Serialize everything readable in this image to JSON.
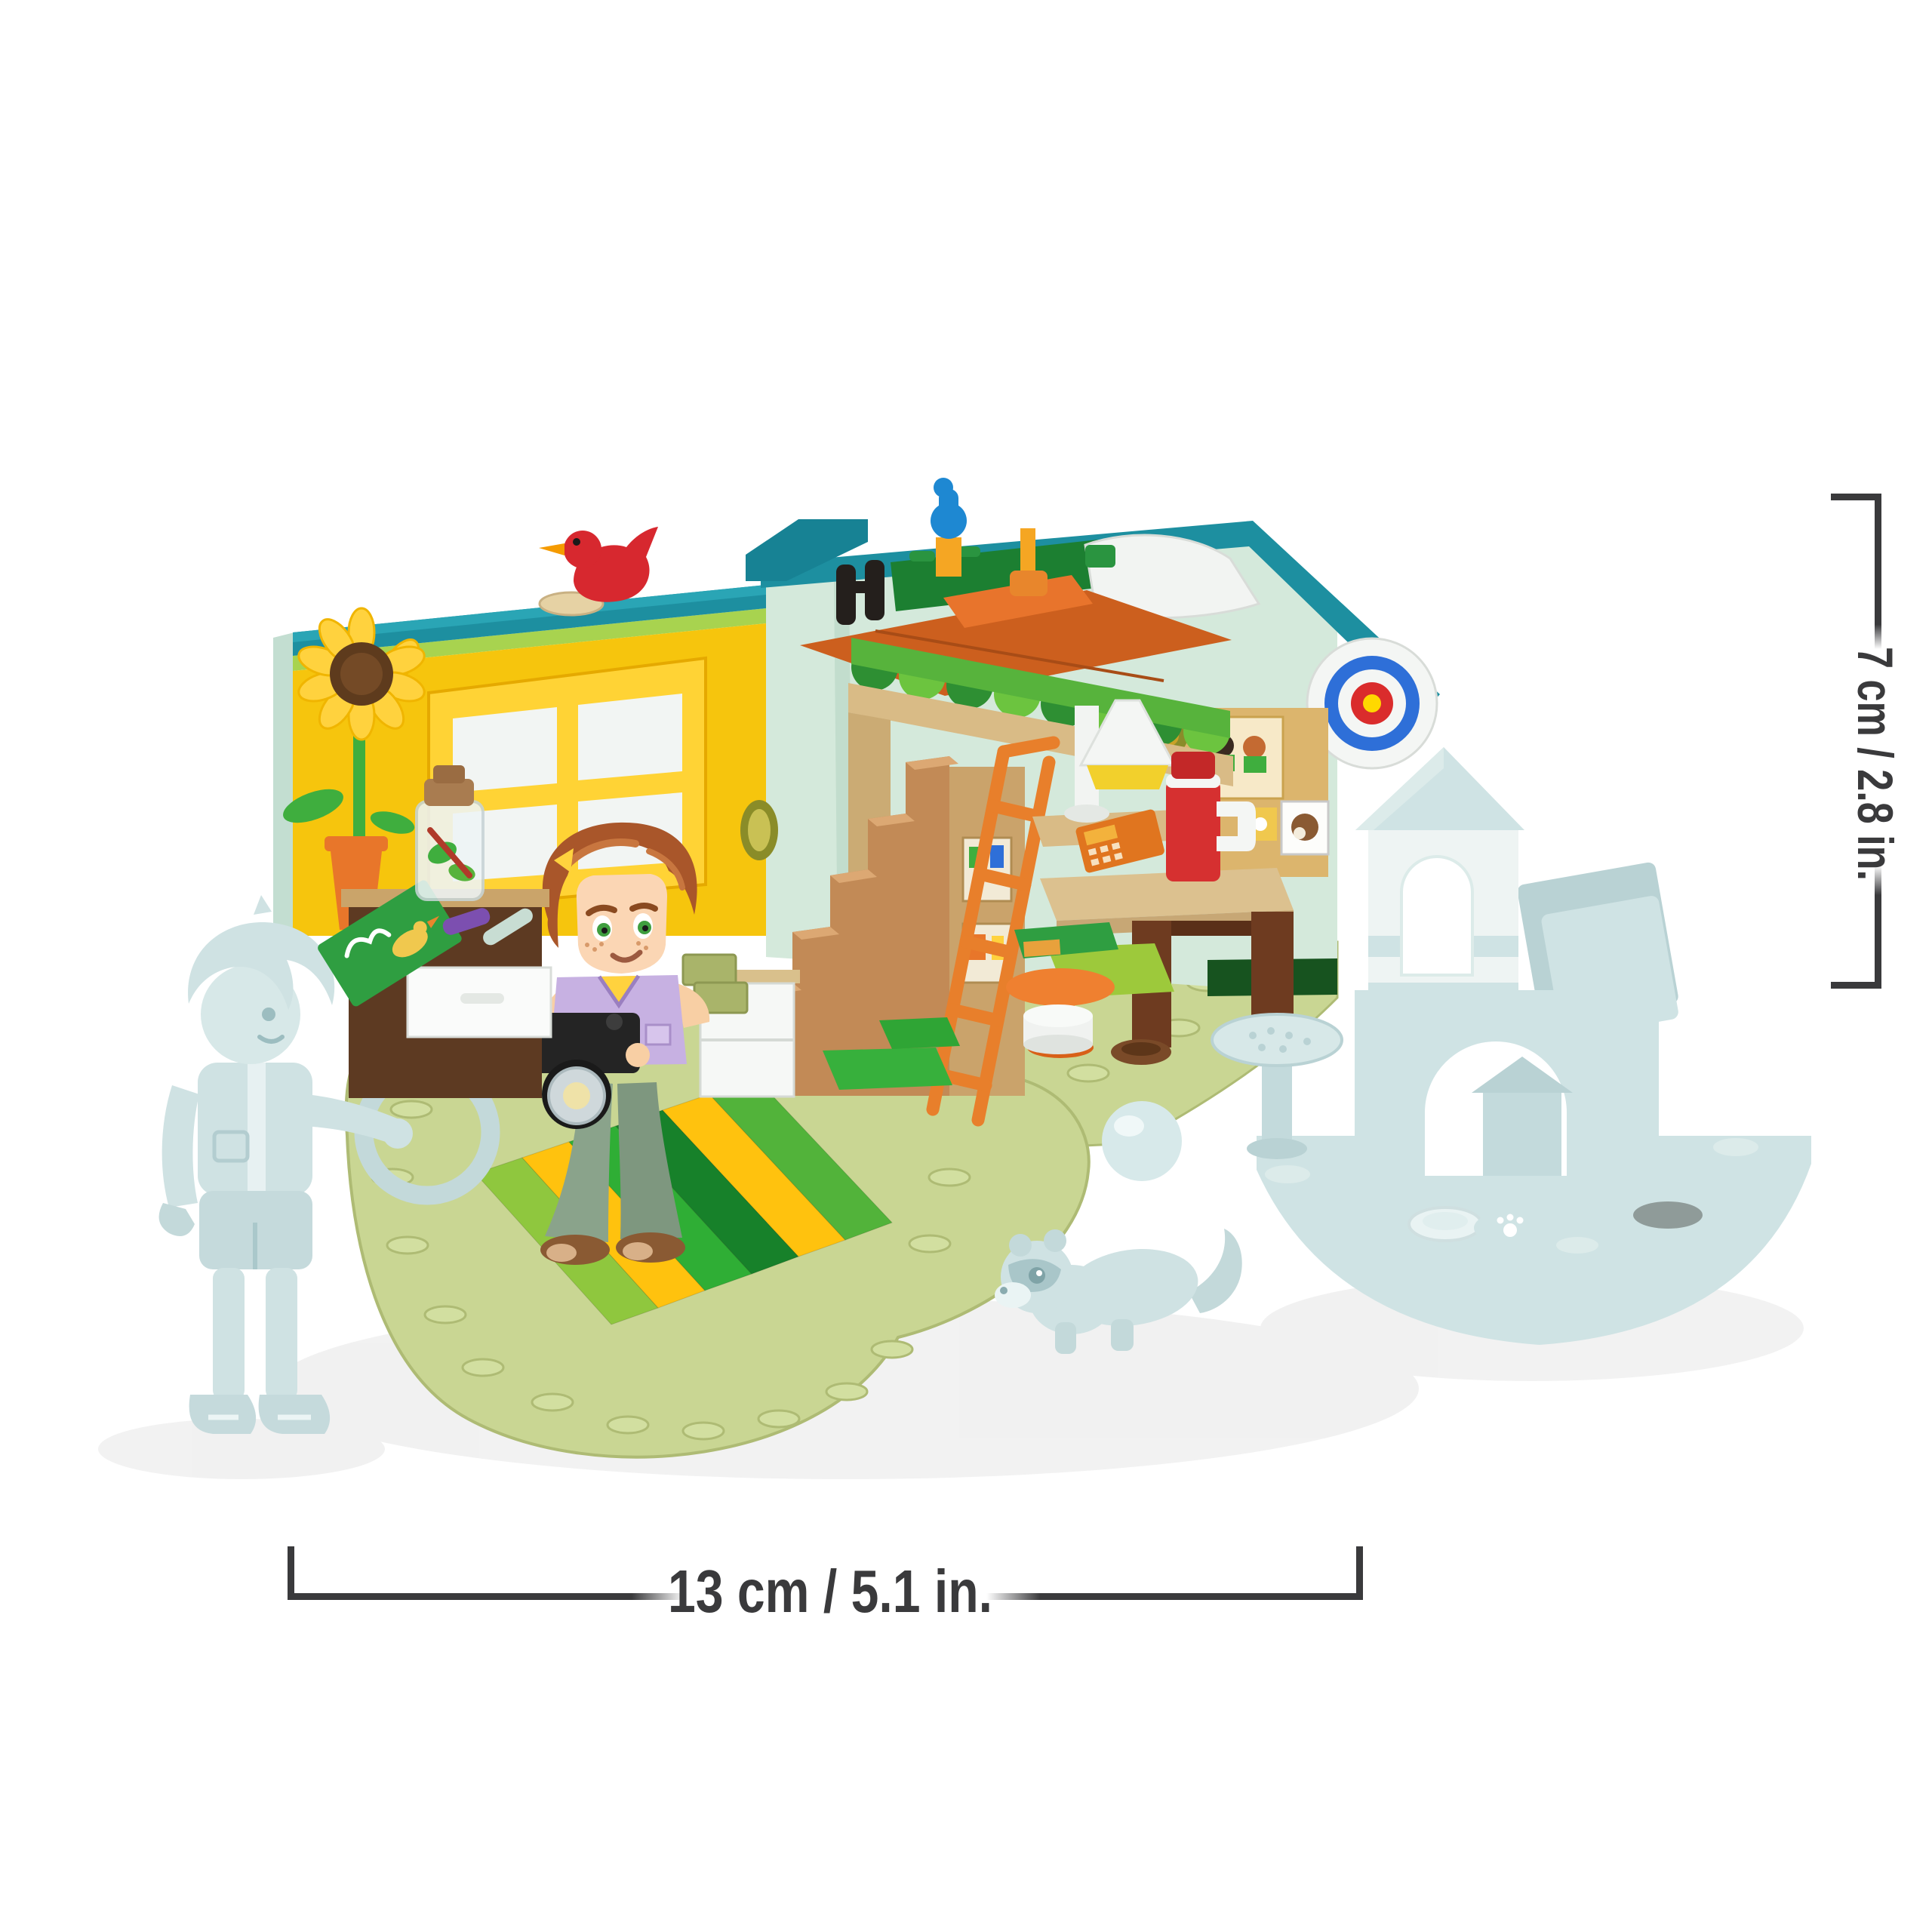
{
  "annotations": {
    "height_label": "7 cm / 2.8 in.",
    "width_label": "13 cm / 5.1 in."
  },
  "scene": {
    "type": "product-photo",
    "subject": "toy-brick room playset with mini-doll, loft bed and translucent ghosted expansion pieces",
    "icons": [
      "sunflower-icon",
      "red-bird-icon",
      "blue-bird-icon",
      "dartboard-target-icon",
      "camera-icon",
      "ladder-icon",
      "staircase-icon",
      "loft-bed-icon",
      "awning-icon",
      "desk-icon",
      "thermos-icon",
      "calculator-icon",
      "floor-lamp-icon",
      "poster-wall-icon",
      "dresser-icon",
      "terrarium-jar-icon",
      "striped-rug-icon",
      "mini-doll-icon",
      "ghost-boy-figure-icon",
      "ghost-hoop-icon",
      "ghost-ball-icon",
      "ghost-ferret-icon",
      "ghost-castle-icon",
      "pet-bowl-icon"
    ],
    "palette": {
      "teal_trim": "#1d8fa0",
      "mint_wall": "#d4e9db",
      "yellow_wall": "#f6c50d",
      "window_frame": "#ffd335",
      "dark_green_skirt": "#17531f",
      "awning_dark_green": "#2e8f33",
      "awning_bright_green": "#6cc43f",
      "olive_baseplate": "#c9d693",
      "rug_yellow": "#ffc20e",
      "rug_green": "#2fae35",
      "stair_nougat": "#c28a56",
      "ladder_orange": "#e87f2b",
      "deck_orange": "#cc5f1e",
      "thermos_red": "#d63030",
      "desk_brown": "#6e3b20",
      "target_blue": "#2e6fd8",
      "target_red": "#da2c2c",
      "target_yellow": "#ffd800",
      "ghost_blue": "#cfe2e4",
      "hair_auburn": "#a9562a",
      "vest_lavender": "#c7b1e2",
      "pants_sage": "#8aa38b",
      "annotation_gray": "#3a3a3c"
    }
  }
}
